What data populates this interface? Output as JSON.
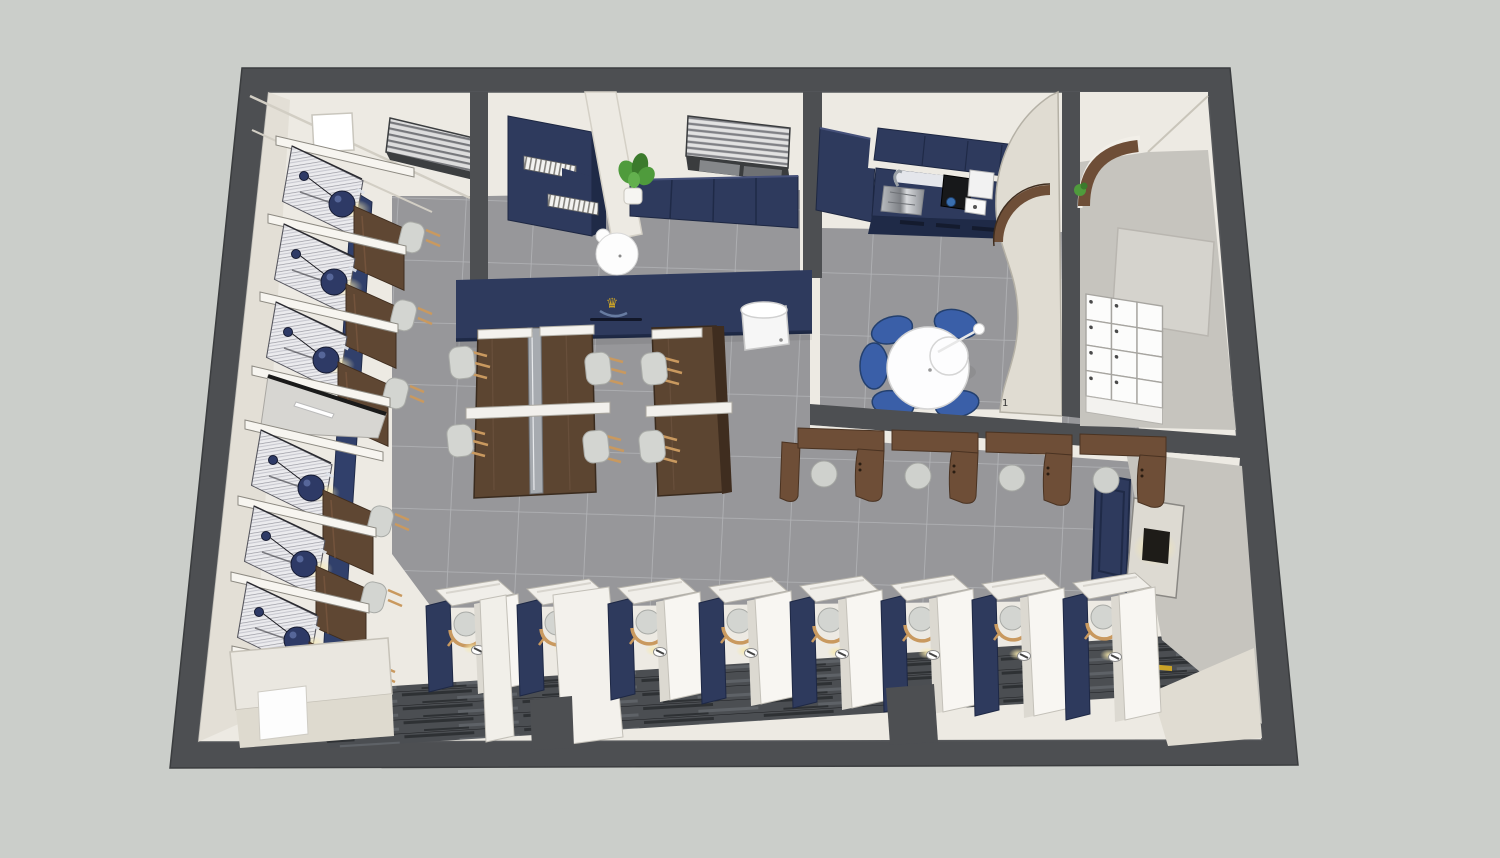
{
  "scene": {
    "type": "3d-interior-floorplan-render",
    "description": "Top-down perspective 3D render of a navy-and-cream study cafe interior with private booths, dining tables, kitchenette, entrance lockers and study carrels",
    "room_label": "1",
    "logo_glyph": "♛"
  },
  "palette": {
    "bg": "#cbceca",
    "band": "#4d4f52",
    "bandLight": "#6f7174",
    "cream": "#edeae3",
    "creamShade": "#e0dcd2",
    "creamDark": "#d2cec4",
    "grayWall": "#c6c4be",
    "grayPanel": "#d5d3cd",
    "tile": "#97979a",
    "tileLine": "#c8c9cd",
    "navy": "#2e3a5d",
    "navyDark": "#1f2a47",
    "navyStrip": "#31406b",
    "wood": "#6e4e37",
    "woodTable": "#5c4531",
    "woodDark": "#3f2d1f",
    "plankMid": "#4b4e52",
    "plankDark": "#2e3134",
    "plankLight": "#5e6267",
    "hatchBase": "#ebebee",
    "hatchLine": "#9a9aa2",
    "chairGray": "#d3d5d1",
    "chairEdge": "#a9aba7",
    "legTan": "#c9995f",
    "blueChair": "#3a5fa8",
    "white": "#fdfdfd",
    "gold": "#c9a227",
    "glow": "#f5e6a8",
    "plant": "#4f9b3c",
    "plantDark": "#3b7a2c"
  },
  "objects": {
    "booth_cells": 6,
    "door_cells": 1,
    "pendant_lamps": 6,
    "booth_desks": 6,
    "booth_chairs": 6,
    "dining_tables": 3,
    "dining_chairs": 6,
    "bench_booths": 4,
    "round_tables": 2,
    "round_table_chairs": 5,
    "study_carrels": 8,
    "locker_rows": 4,
    "locker_cols": 3,
    "windows_with_blinds": 2,
    "plants": 2,
    "wall_art": 1,
    "water_dispensers": 1
  }
}
